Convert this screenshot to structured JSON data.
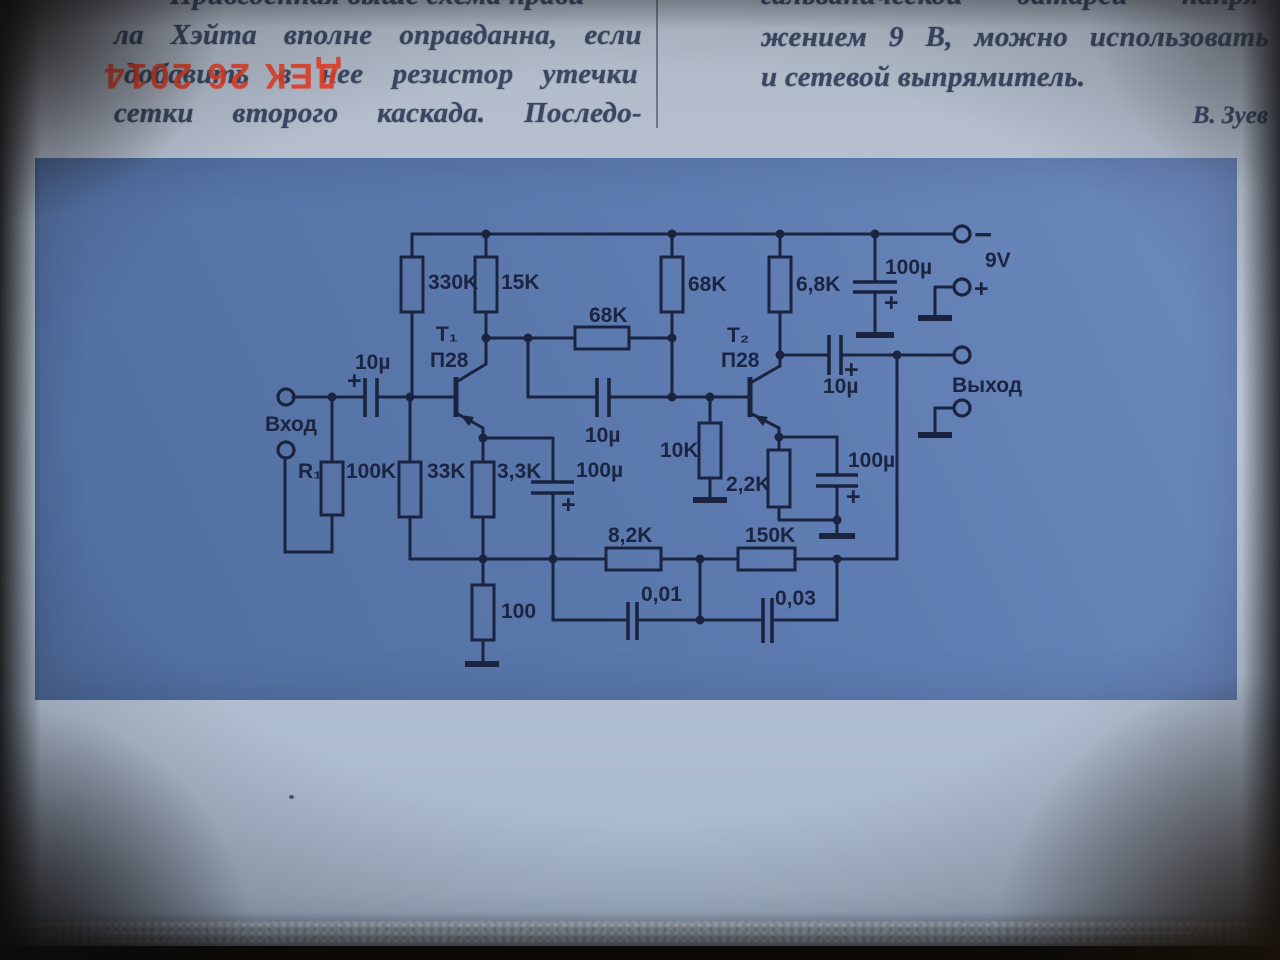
{
  "article": {
    "left_column": {
      "lines": [
        "Приведенная выше схема прави-",
        "ла Хэйта вполне оправданна, если",
        "добавить в нее резистор утечки",
        "сетки второго каскада. Последо-"
      ]
    },
    "right_column": {
      "lines": [
        "гальванической батареи напря-",
        "жением 9 В, можно использовать",
        "и сетевой выпрямитель."
      ],
      "author": "В. Зуев"
    },
    "stamp": "ДЕК 26 2014"
  },
  "schematic": {
    "input_label": "Вход",
    "output_label": "Выход",
    "battery": {
      "voltage": "9V",
      "minus": "−",
      "plus": "+"
    },
    "transistors": {
      "t1": {
        "name": "Т₁",
        "type": "П28"
      },
      "t2": {
        "name": "Т₂",
        "type": "П28"
      }
    },
    "resistors": {
      "r1_name": "R₁",
      "r1_value": "100K",
      "r330k": "330K",
      "r15k": "15K",
      "r33k": "33K",
      "r3k3": "3,3K",
      "r68k_fb": "68K",
      "r68k": "68K",
      "r6k8": "6,8K",
      "r10k": "10K",
      "r2k2": "2,2K",
      "r100": "100",
      "r8k2": "8,2K",
      "r150k": "150K"
    },
    "capacitors": {
      "c_in": "10µ",
      "c_e1": "100µ",
      "c_mid": "10µ",
      "c_out": "10µ",
      "c_e2": "100µ",
      "c_pwr": "100µ",
      "c_fb1": "0,01",
      "c_fb2": "0,03",
      "polarity": "+"
    }
  }
}
